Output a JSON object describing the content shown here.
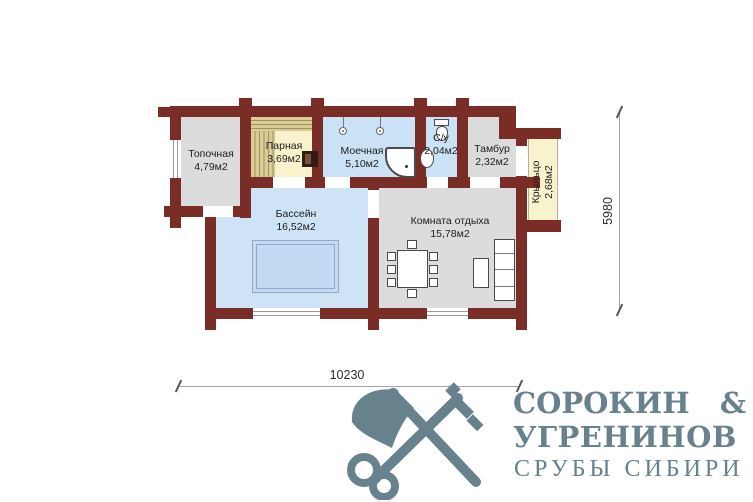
{
  "plan": {
    "rooms": {
      "topochnaya": {
        "name": "Топочная",
        "area": "4,79м2"
      },
      "parnaya": {
        "name": "Парная",
        "area": "3,69м2"
      },
      "moechnaya": {
        "name": "Моечная",
        "area": "5,10м2"
      },
      "su": {
        "name": "С/у",
        "area": "2,04м2"
      },
      "tambur": {
        "name": "Тамбур",
        "area": "2,32м2"
      },
      "kryltso": {
        "name": "Крыльцо",
        "area": "2,68м2"
      },
      "bassein": {
        "name": "Бассейн",
        "area": "16,52м2"
      },
      "komnata_otdyha": {
        "name": "Комната отдыха",
        "area": "15,78м2"
      }
    },
    "dimensions": {
      "width_mm": "10230",
      "height_mm": "5980"
    },
    "colors": {
      "wall": "#7a2c26",
      "wet_room": "#cbe1f6",
      "pool_room": "#cfe3f7",
      "pool_basin": "#c3dbf2",
      "dry_room": "#dcdcdc",
      "wood_room": "#f8f3cd",
      "bench": "#d9cc95",
      "logo": "#67828c"
    },
    "fixture_icons": [
      "pool",
      "dining-table",
      "chair",
      "sofa",
      "cabinet",
      "shower-tray",
      "shower-head",
      "toilet",
      "sink",
      "stove",
      "bench"
    ]
  },
  "logo": {
    "icon": "axe-and-key",
    "line1_name": "СОРОКИН",
    "line1_amp": "&",
    "line2": "УГРЕНИНОВ",
    "line3": "СРУБЫ СИБИРИ"
  }
}
